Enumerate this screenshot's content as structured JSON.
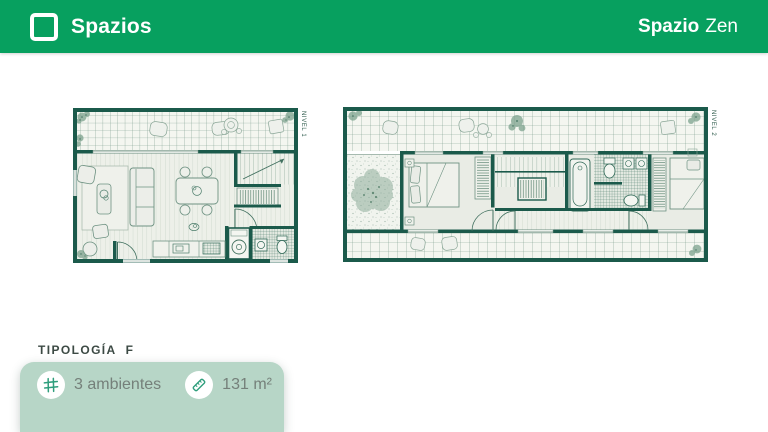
{
  "header": {
    "brand": "Spazios",
    "project": {
      "bold": "Spazio",
      "regular": "Zen"
    },
    "bg_color": "#07a05f"
  },
  "plans": [
    {
      "label": "NIVEL 1"
    },
    {
      "label": "NIVEL 2"
    }
  ],
  "typology": {
    "title": "TIPOLOGÍA",
    "variant": "F"
  },
  "features": {
    "rooms": "3 ambientes",
    "rooms_icon": "hash-grid-icon",
    "area": "131 m²",
    "area_icon": "ruler-icon"
  },
  "colors": {
    "wall_green": "#1b5a4b",
    "card_mint": "#b7d6c7",
    "icon_green": "#2f9e7c"
  }
}
